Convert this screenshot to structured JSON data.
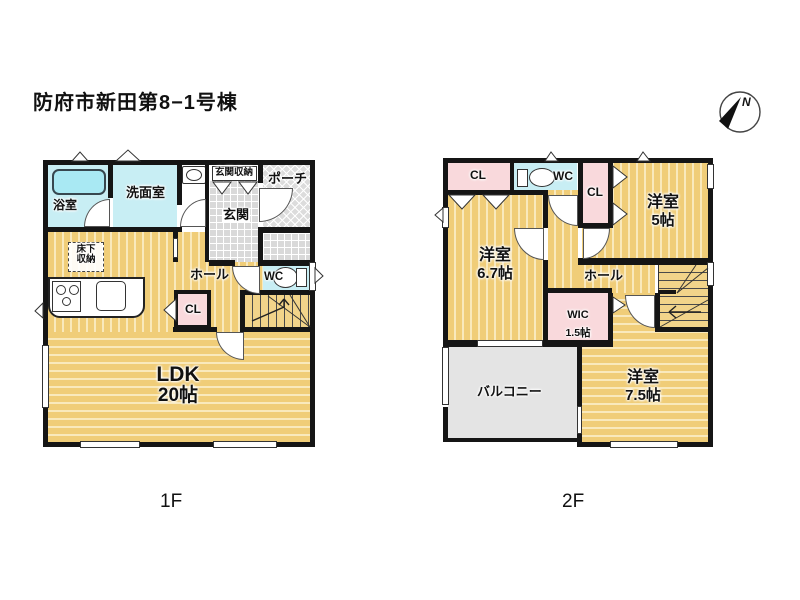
{
  "title": "防府市新田第8−1号棟",
  "compass": {
    "north_label": "N"
  },
  "floor1": {
    "label": "1F",
    "rooms": {
      "bath": "浴室",
      "washroom": "洗面室",
      "entrance_storage": "玄関収納",
      "porch": "ポーチ",
      "entrance": "玄関",
      "underfloor_storage": {
        "line1": "床下",
        "line2": "収納"
      },
      "hall": "ホール",
      "wc": "WC",
      "closet": "CL",
      "ldk": {
        "line1": "LDK",
        "line2": "20帖"
      }
    }
  },
  "floor2": {
    "label": "2F",
    "rooms": {
      "closet_left": "CL",
      "wc": "WC",
      "closet_right": "CL",
      "bedroom_5": {
        "line1": "洋室",
        "line2": "5帖"
      },
      "bedroom_6_7": {
        "line1": "洋室",
        "line2": "6.7帖"
      },
      "hall": "ホール",
      "wic": {
        "line1": "WIC",
        "line2": "1.5帖"
      },
      "balcony": "バルコニー",
      "bedroom_7_5": {
        "line1": "洋室",
        "line2": "7.5帖"
      }
    }
  },
  "colors": {
    "wall": "#151515",
    "floor_yellow": "#f0cd78",
    "floor_stripe_light": "#f9e9bc",
    "water_cyan": "#c8eef4",
    "bathtub_cyan": "#a9e9f3",
    "closet_pink": "#f9d9dc",
    "tile_gray": "#d9d9d9",
    "balcony_gray": "#e4e4e4"
  }
}
